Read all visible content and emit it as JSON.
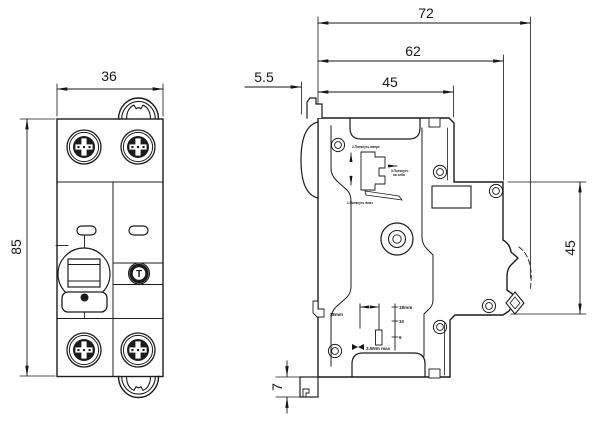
{
  "drawing": {
    "front_view": {
      "width_dim": "36",
      "height_dim": "85",
      "test_button_label": "T"
    },
    "side_view": {
      "total_depth_dim": "72",
      "body_depth_dim": "62",
      "front_depth_dim": "45",
      "handle_protrusion_dim": "5.5",
      "rail_section_height_dim": "45",
      "foot_height_dim": "7",
      "molded_markings": {
        "strip_length_left": "18mm",
        "strip_length_right": "18mm",
        "wire_size_mid": "10",
        "wire_size_low": "6",
        "torque_max": "3.5Nm max",
        "instruction_step2": "2.Потянуть вверх",
        "instruction_step3_line1": "3.Потянуть",
        "instruction_step3_line2": "на себя",
        "instruction_step1": "1.Потянуть вниз"
      }
    },
    "colors": {
      "line": "#1c1c1c",
      "background": "#ffffff"
    }
  }
}
